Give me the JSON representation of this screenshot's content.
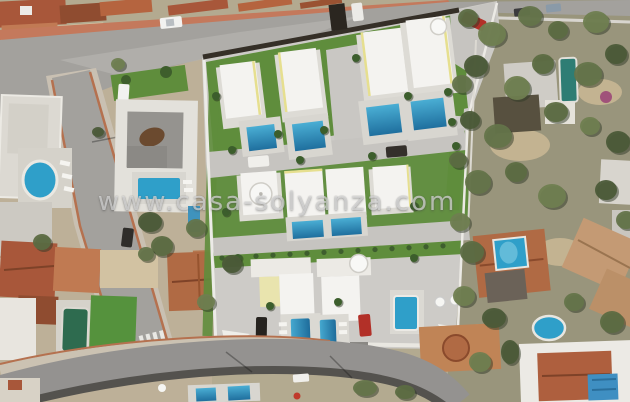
{
  "watermark": {
    "text": "www.casa-solyanza.com"
  },
  "colors": {
    "pool_blue": "#2f9fc9",
    "pool_deep": "#1f6f9e",
    "pool_teal": "#2e7d74",
    "pool_green": "#2e6b4f",
    "lawn_green": "#5f8d3c",
    "road_gray": "#a3a19d",
    "concrete": "#cdcbc7",
    "roof_terracotta": "#a8573a",
    "villa_white": "#f4f3f0",
    "wall_dark": "#352f27",
    "sidewalk_pink": "#c4795c",
    "veg_olive": "#99957c"
  }
}
